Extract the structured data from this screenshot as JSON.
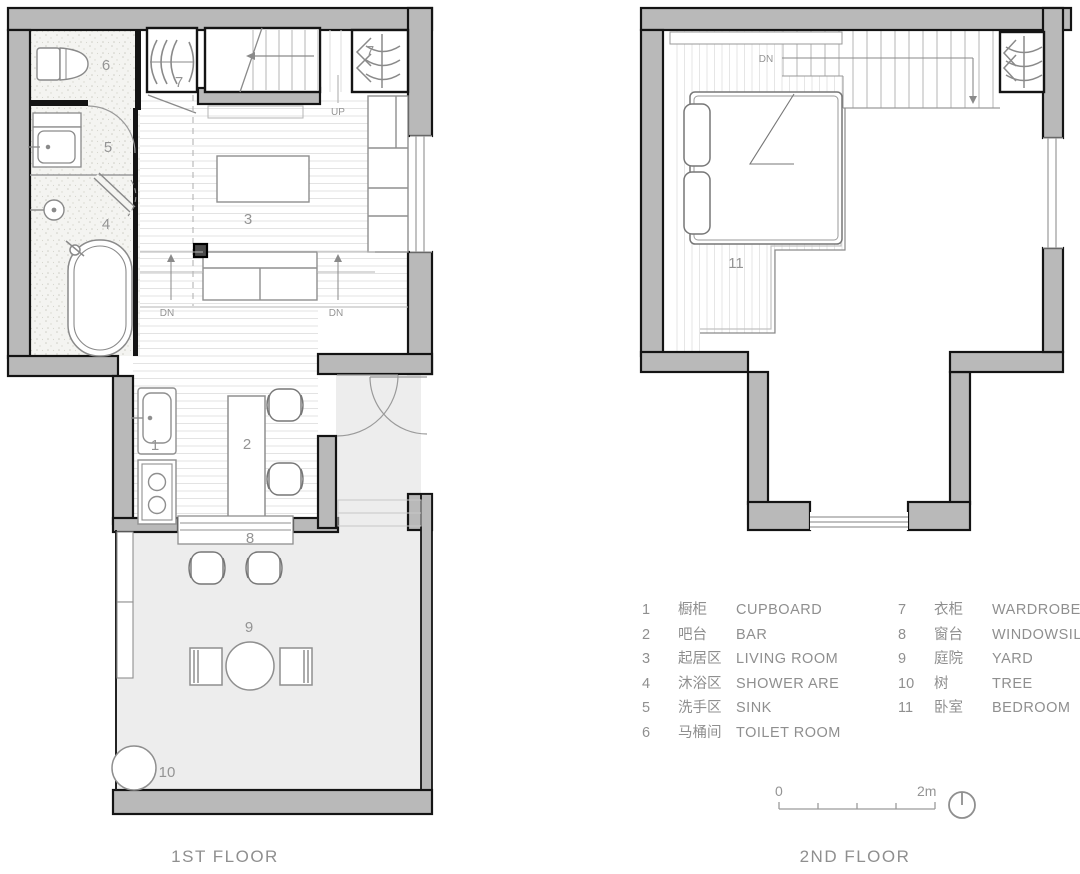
{
  "page": {
    "type": "apartment floor plan drawing",
    "colors": {
      "wall_fill": "#b9b9b9",
      "wall_stroke": "#141414",
      "floor_line": "#e2e2e2",
      "furniture_line": "#8a8a8a",
      "label_text": "#949494",
      "yard_fill": "#ededed",
      "bath_fill": "#f4f4f1"
    }
  },
  "floor1": {
    "title": "1ST FLOOR",
    "labels": {
      "up": "UP",
      "dn_left": "DN",
      "dn_right": "DN"
    },
    "rooms": {
      "cupboard": "1",
      "bar": "2",
      "living": "3",
      "shower": "4",
      "sink": "5",
      "toilet": "6",
      "wardrobe_left": "7",
      "wardrobe_right": "7",
      "windowsill": "8",
      "yard": "9",
      "tree": "10"
    }
  },
  "floor2": {
    "title": "2ND FLOOR",
    "labels": {
      "dn": "DN"
    },
    "rooms": {
      "bedroom": "11"
    }
  },
  "legend": {
    "column1": [
      {
        "num": "1",
        "zh": "橱柜",
        "en": "CUPBOARD"
      },
      {
        "num": "2",
        "zh": "吧台",
        "en": "BAR"
      },
      {
        "num": "3",
        "zh": "起居区",
        "en": "LIVING ROOM"
      },
      {
        "num": "4",
        "zh": "沐浴区",
        "en": "SHOWER ARE"
      },
      {
        "num": "5",
        "zh": "洗手区",
        "en": "SINK"
      },
      {
        "num": "6",
        "zh": "马桶间",
        "en": "TOILET ROOM"
      }
    ],
    "column2": [
      {
        "num": "7",
        "zh": "衣柜",
        "en": "WARDROBE"
      },
      {
        "num": "8",
        "zh": "窗台",
        "en": "WINDOWSILL"
      },
      {
        "num": "9",
        "zh": "庭院",
        "en": "YARD"
      },
      {
        "num": "10",
        "zh": "树",
        "en": "TREE"
      },
      {
        "num": "11",
        "zh": "卧室",
        "en": "BEDROOM"
      }
    ]
  },
  "scale_bar": {
    "zero": "0",
    "two_m": "2m"
  }
}
